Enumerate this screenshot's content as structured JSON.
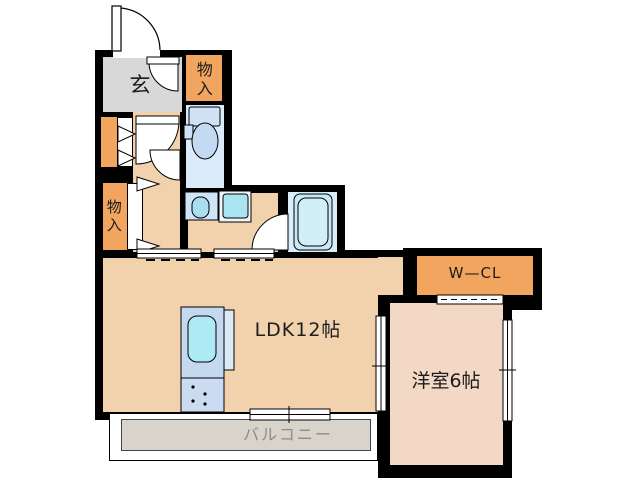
{
  "plan": {
    "title": "apartment-floor-plan",
    "rooms": {
      "genkan_label": "玄",
      "storage_top_label": "物入",
      "storage_left_label": "物入",
      "walk_in_closet_label": "W—CL",
      "ldk_label": "LDK12帖",
      "western_room_label": "洋室6帖",
      "balcony_label": "バルコニー"
    },
    "colors": {
      "wall_black": "#000000",
      "floor_tan": "#f2d2ad",
      "western_room_pink": "#f3d8c6",
      "storage_orange": "#f1a55e",
      "entry_gray": "#d8d8d8",
      "balcony_gray": "#d8d3cb",
      "toilet_room_blue": "#dcebfa",
      "bathroom_blue": "#daedf8",
      "fixture_blue": "#ace8f4",
      "balcony_text_gray": "#8c8c8c"
    }
  }
}
